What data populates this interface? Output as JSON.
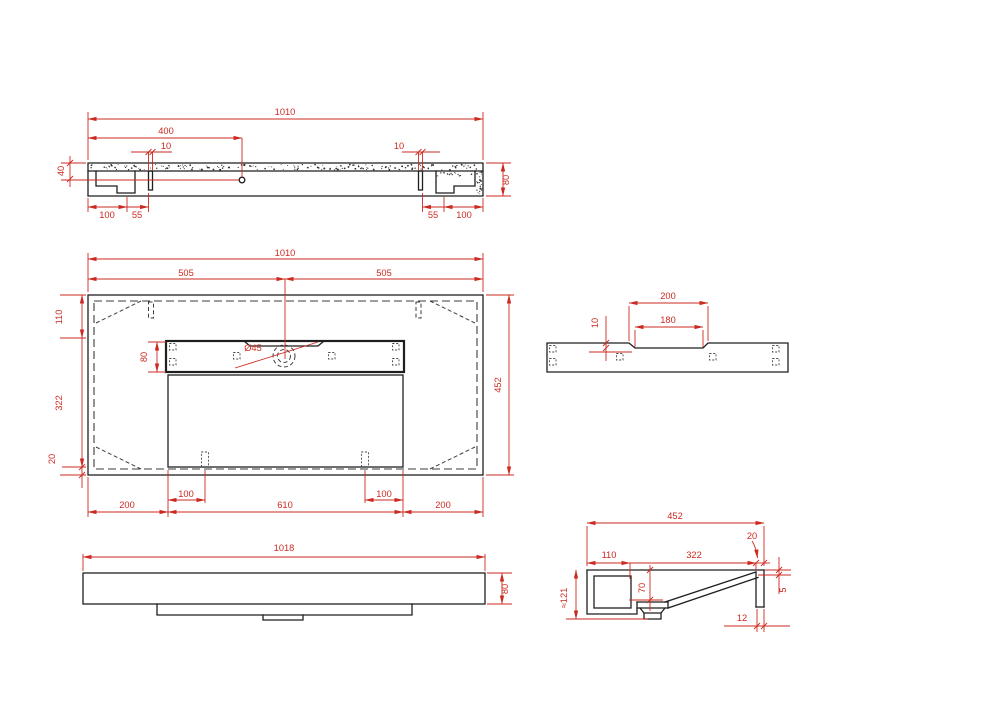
{
  "drawing": {
    "background": "#ffffff",
    "line_color": "#1f1f1f",
    "hidden_line_color": "#3d3d3d",
    "dimension_color": "#cc2a21",
    "views": [
      {
        "id": "top-profile-view",
        "label": "bottom profile view",
        "dimensions": [
          {
            "text": "1010",
            "x": 285,
            "y": 115,
            "rot": 0
          },
          {
            "text": "400",
            "x": 166,
            "y": 134,
            "rot": 0
          },
          {
            "text": "10",
            "x": 166,
            "y": 149,
            "rot": 0
          },
          {
            "text": "10",
            "x": 399,
            "y": 149,
            "rot": 0
          },
          {
            "text": "40",
            "x": 64,
            "y": 171,
            "rot": -90
          },
          {
            "text": "80",
            "x": 509,
            "y": 180,
            "rot": -90
          },
          {
            "text": "100",
            "x": 107,
            "y": 218,
            "rot": 0
          },
          {
            "text": "55",
            "x": 137,
            "y": 218,
            "rot": 0
          },
          {
            "text": "55",
            "x": 433,
            "y": 218,
            "rot": 0
          },
          {
            "text": "100",
            "x": 464,
            "y": 218,
            "rot": 0
          }
        ]
      },
      {
        "id": "plan-view",
        "label": "plan view of basin underside",
        "dimensions": [
          {
            "text": "1010",
            "x": 285,
            "y": 256,
            "rot": 0
          },
          {
            "text": "505",
            "x": 186,
            "y": 276,
            "rot": 0
          },
          {
            "text": "505",
            "x": 384,
            "y": 276,
            "rot": 0
          },
          {
            "text": "110",
            "x": 62,
            "y": 317,
            "rot": -90
          },
          {
            "text": "80",
            "x": 147,
            "y": 357,
            "rot": -90
          },
          {
            "text": "Ø45",
            "x": 253,
            "y": 351,
            "rot": 0
          },
          {
            "text": "322",
            "x": 62,
            "y": 403,
            "rot": -90
          },
          {
            "text": "20",
            "x": 55,
            "y": 459,
            "rot": -90
          },
          {
            "text": "452",
            "x": 501,
            "y": 385,
            "rot": -90
          },
          {
            "text": "100",
            "x": 186,
            "y": 497,
            "rot": 0
          },
          {
            "text": "100",
            "x": 384,
            "y": 497,
            "rot": 0
          },
          {
            "text": "200",
            "x": 127,
            "y": 508,
            "rot": 0
          },
          {
            "text": "610",
            "x": 285,
            "y": 508,
            "rot": 0
          },
          {
            "text": "200",
            "x": 443,
            "y": 508,
            "rot": 0
          }
        ]
      },
      {
        "id": "deck-section-view",
        "label": "faucet deck section",
        "dimensions": [
          {
            "text": "200",
            "x": 668,
            "y": 299,
            "rot": 0
          },
          {
            "text": "180",
            "x": 668,
            "y": 323,
            "rot": 0
          },
          {
            "text": "10",
            "x": 598,
            "y": 323,
            "rot": -90
          }
        ]
      },
      {
        "id": "front-elevation-view",
        "label": "front elevation",
        "dimensions": [
          {
            "text": "1018",
            "x": 284,
            "y": 551,
            "rot": 0
          },
          {
            "text": "80",
            "x": 508,
            "y": 589,
            "rot": -90
          }
        ]
      },
      {
        "id": "side-section-view",
        "label": "side cross-section",
        "dimensions": [
          {
            "text": "452",
            "x": 675,
            "y": 519,
            "rot": 0
          },
          {
            "text": "110",
            "x": 609,
            "y": 558,
            "rot": 0
          },
          {
            "text": "322",
            "x": 694,
            "y": 558,
            "rot": 0
          },
          {
            "text": "20",
            "x": 752,
            "y": 539,
            "rot": 0
          },
          {
            "text": "5",
            "x": 786,
            "y": 590,
            "rot": -90
          },
          {
            "text": "70",
            "x": 645,
            "y": 588,
            "rot": -90
          },
          {
            "text": "≈121",
            "x": 567,
            "y": 598,
            "rot": -90
          },
          {
            "text": "12",
            "x": 742,
            "y": 621,
            "rot": 0
          }
        ]
      }
    ]
  }
}
